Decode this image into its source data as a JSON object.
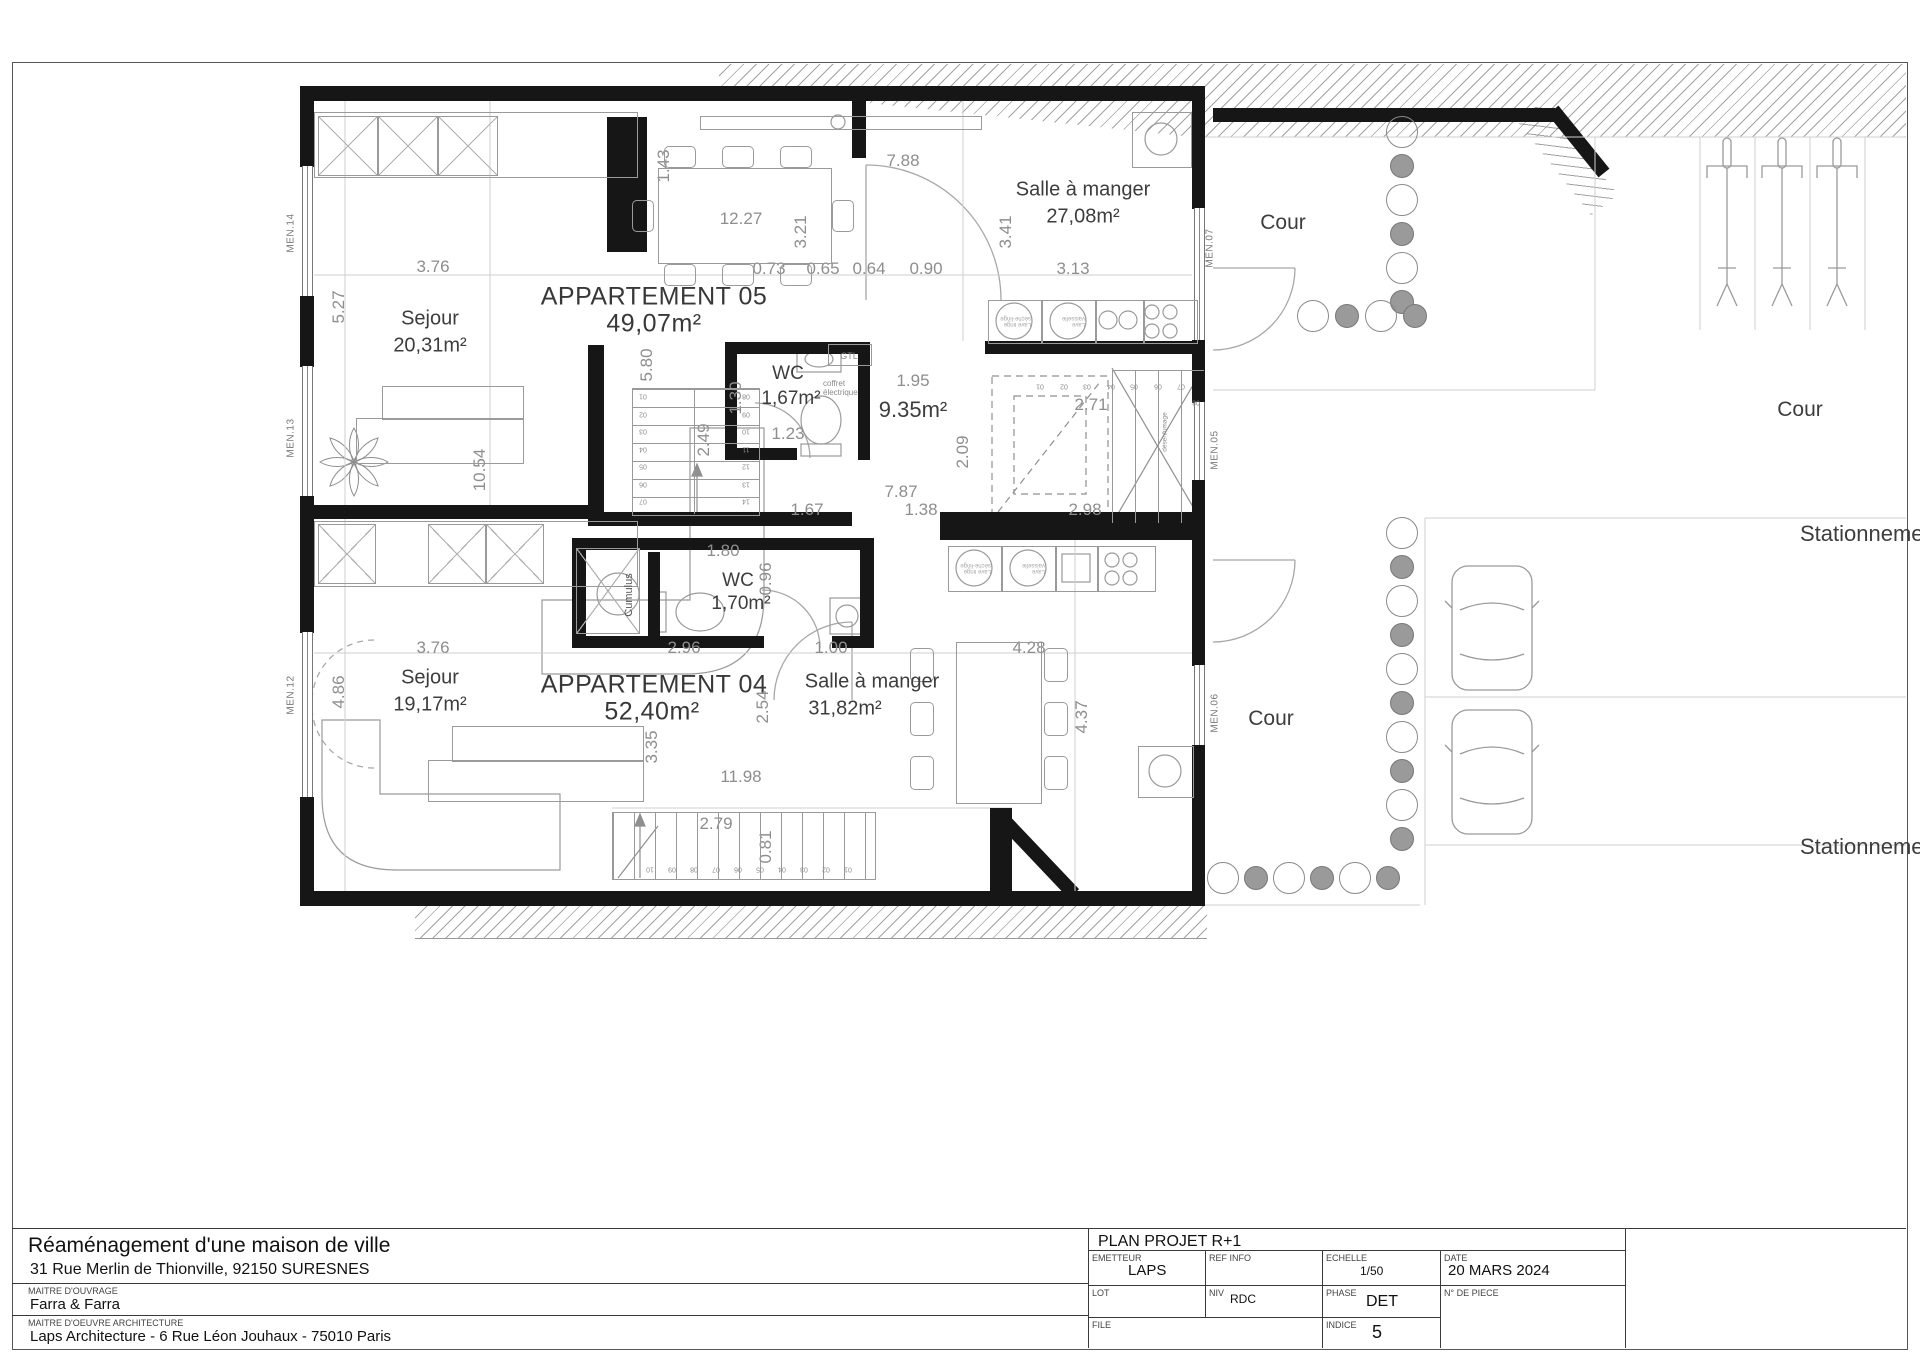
{
  "plan": {
    "apartments": [
      {
        "name": "APPARTEMENT 05",
        "area": "49,07m²"
      },
      {
        "name": "APPARTEMENT 04",
        "area": "52,40m²"
      }
    ],
    "rooms": [
      {
        "name": "Sejour",
        "area": "20,31m²"
      },
      {
        "name": "Salle à manger",
        "area": "27,08m²"
      },
      {
        "name": "WC",
        "area": "1,67m²"
      },
      {
        "name": "Sejour",
        "area": "19,17m²"
      },
      {
        "name": "Salle à manger",
        "area": "31,82m²"
      },
      {
        "name": "WC",
        "area": "1,70m²"
      }
    ],
    "hall_label": "9.35m²",
    "outdoor": {
      "cour": "Cour",
      "stationnement": "Stationnement"
    },
    "equipment": {
      "gtl": "GTL",
      "coffret": "coffret électrique",
      "cumulus": "Cumulus",
      "desenfumage": "désenfumage"
    },
    "appliance_labels": [
      "Lave linge sèche-linge",
      "Lave vaisselle"
    ],
    "window_labels": [
      "MEN.14",
      "MEN.13",
      "MEN.12",
      "MEN.07",
      "MEN.05",
      "MEN.06"
    ],
    "dimensions": [
      "1.43",
      "7.88",
      "12.27",
      "3.21",
      "3.41",
      "3.76",
      "0.73",
      "0.65",
      "0.64",
      "0.90",
      "3.13",
      "5.27",
      "5.80",
      "1.30",
      "1.23",
      "1.95",
      "2.71",
      "2.09",
      "2.49",
      "10.54",
      "7.87",
      "1.67",
      "1.38",
      "2.98",
      "1.80",
      "0.96",
      "2.96",
      "1.00",
      "4.28",
      "3.76",
      "4.86",
      "2.54",
      "4.37",
      "3.35",
      "11.98",
      "2.79",
      "0.81"
    ],
    "stairs": {
      "central_left": [
        "01",
        "02",
        "03",
        "04",
        "05",
        "06",
        "07"
      ],
      "central_right": [
        "08",
        "09",
        "10",
        "11",
        "12",
        "13",
        "14"
      ],
      "upper_run": [
        "01",
        "02",
        "03",
        "04",
        "05",
        "06",
        "07",
        "08"
      ],
      "lower_run": [
        "01",
        "02",
        "03",
        "04",
        "05",
        "06",
        "07",
        "08",
        "09",
        "10"
      ]
    }
  },
  "title_block": {
    "project_title": "Réaménagement d'une maison de ville",
    "project_address": "31 Rue Merlin de Thionville, 92150 SURESNES",
    "maitre_ouvrage_label": "MAITRE D'OUVRAGE",
    "maitre_ouvrage": "Farra & Farra",
    "maitre_oeuvre_label": "MAITRE D'OEUVRE ARCHITECTURE",
    "maitre_oeuvre": "Laps Architecture - 6 Rue Léon Jouhaux - 75010 Paris",
    "drawing_title": "PLAN PROJET R+1",
    "emetteur_label": "EMETTEUR",
    "emetteur": "LAPS",
    "ref_info_label": "REF INFO",
    "ref_info": "",
    "echelle_label": "ECHELLE",
    "echelle": "1/50",
    "date_label": "DATE",
    "date": "20 MARS 2024",
    "lot_label": "LOT",
    "lot": "",
    "niv_label": "NIV",
    "niv": "RDC",
    "phase_label": "PHASE",
    "phase": "DET",
    "piece_label": "N° DE PIECE",
    "piece": "",
    "file_label": "FILE",
    "file": "",
    "indice_label": "INDICE",
    "indice": "5"
  }
}
